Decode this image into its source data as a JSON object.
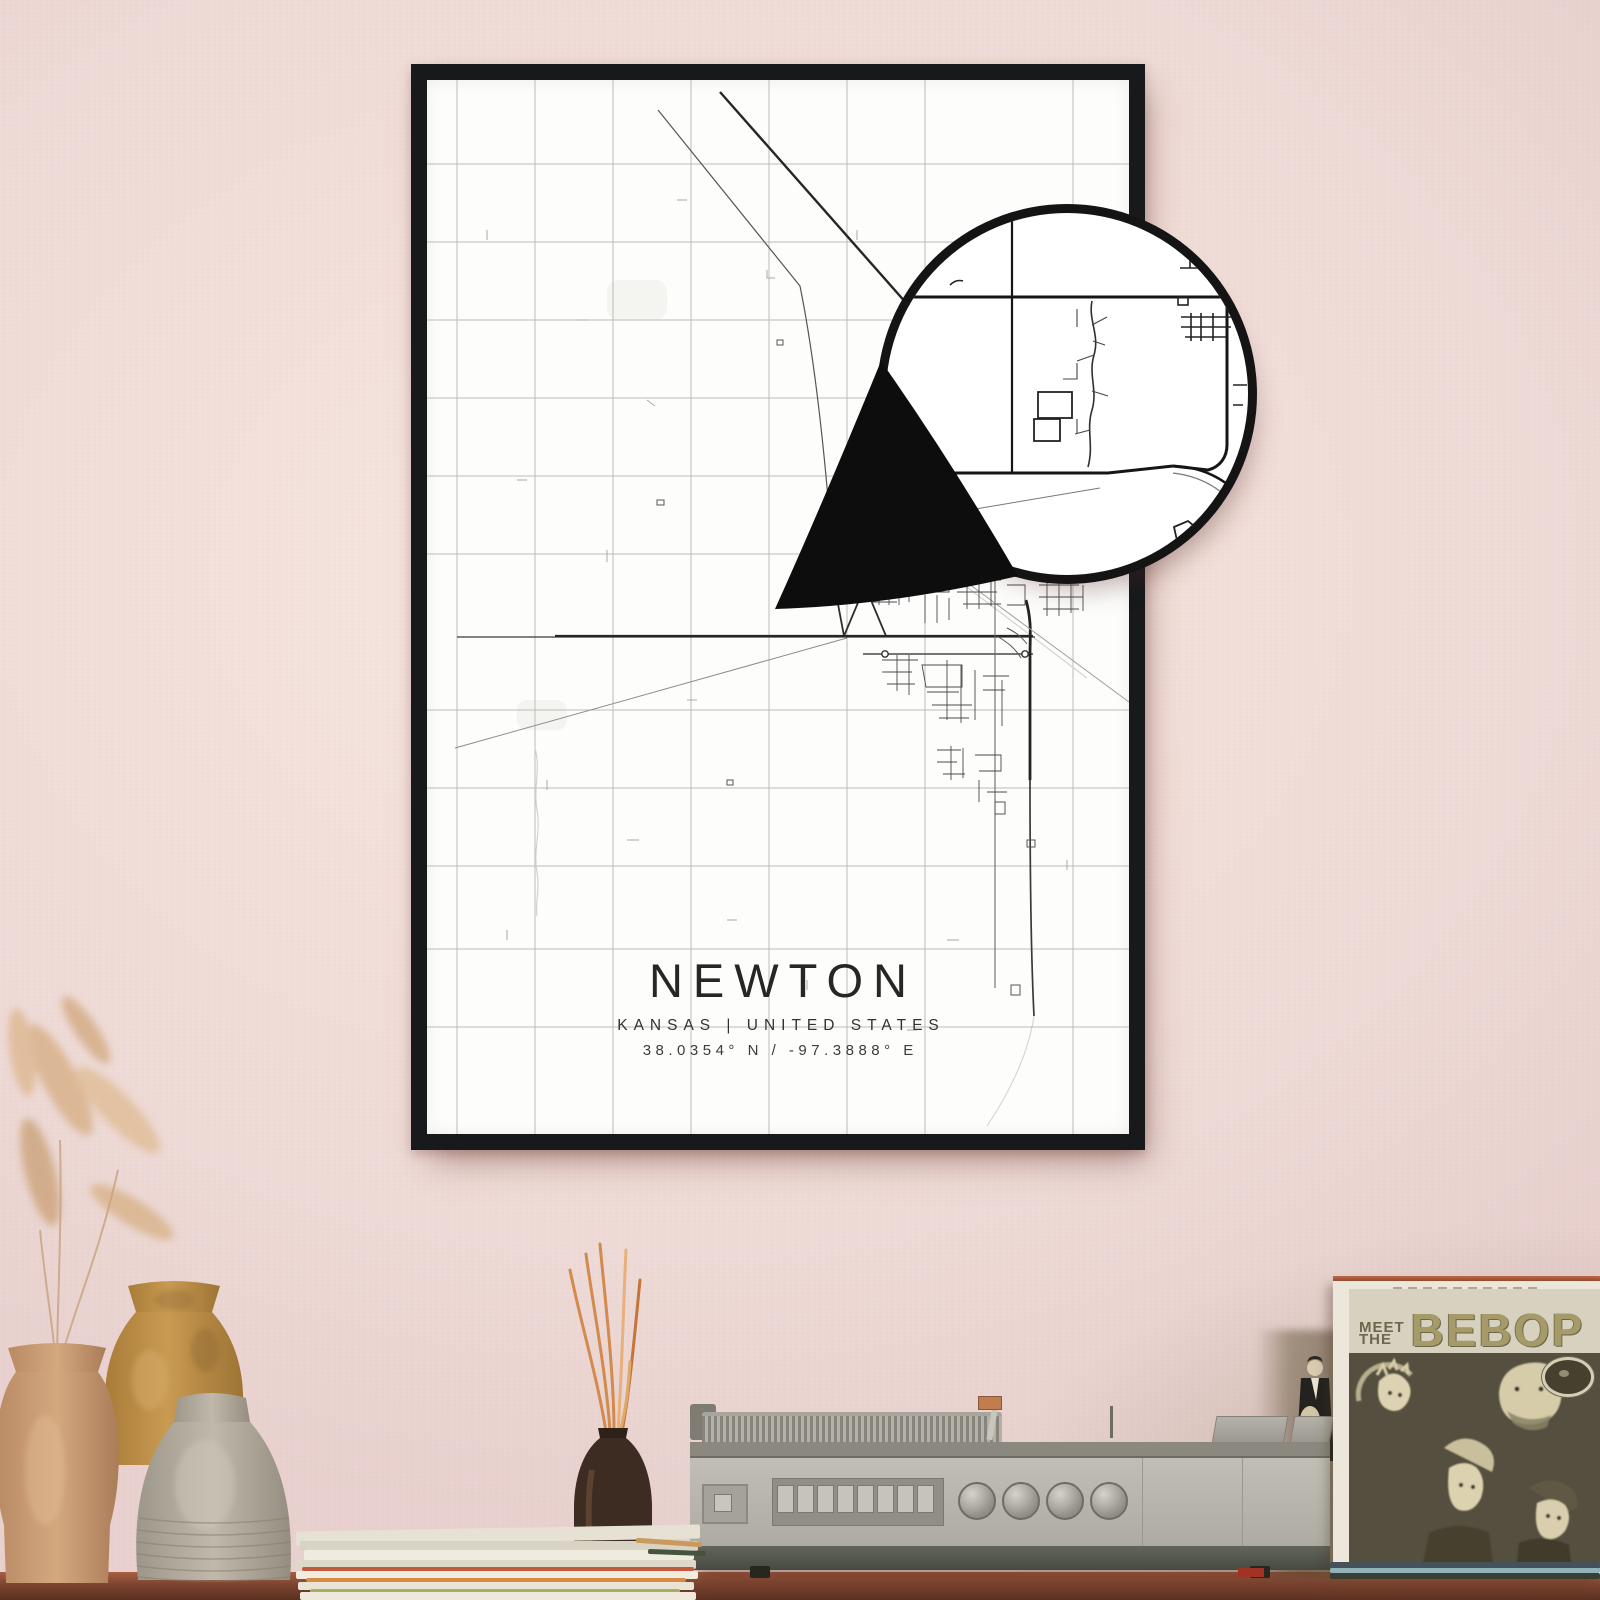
{
  "wall": {
    "color_center": "#f7e8e3",
    "color_edge": "#e8d1ce"
  },
  "table": {
    "wood_color": "#7c4430"
  },
  "poster": {
    "title": "NEWTON",
    "subtitle": "KANSAS | UNITED STATES",
    "coordinates": "38.0354° N / -97.3888° E",
    "frame_color": "#17191b",
    "paper_color": "#fdfdfc",
    "road_color_dark": "#262626",
    "road_color_light": "#b9b9b9"
  },
  "magnifier": {
    "ring_color": "#141414"
  },
  "album": {
    "title_prefix_line1": "MEET",
    "title_prefix_line2": "THE",
    "title_main": "BEBOP",
    "band_color": "#d7d1c0",
    "art_color": "#544f3e",
    "title_color": "#a59a68"
  },
  "record_player": {
    "body_color": "#b7b5ac",
    "base_color": "#474a40"
  },
  "decor": {
    "vase_tan_color": "#c59a76",
    "vase_ochre_color": "#b98a45",
    "vase_gray_color": "#b0a89a",
    "diffuser_color": "#3c2c22",
    "stick_color": "#d28a4e",
    "pampas_color": "#dbb795"
  }
}
